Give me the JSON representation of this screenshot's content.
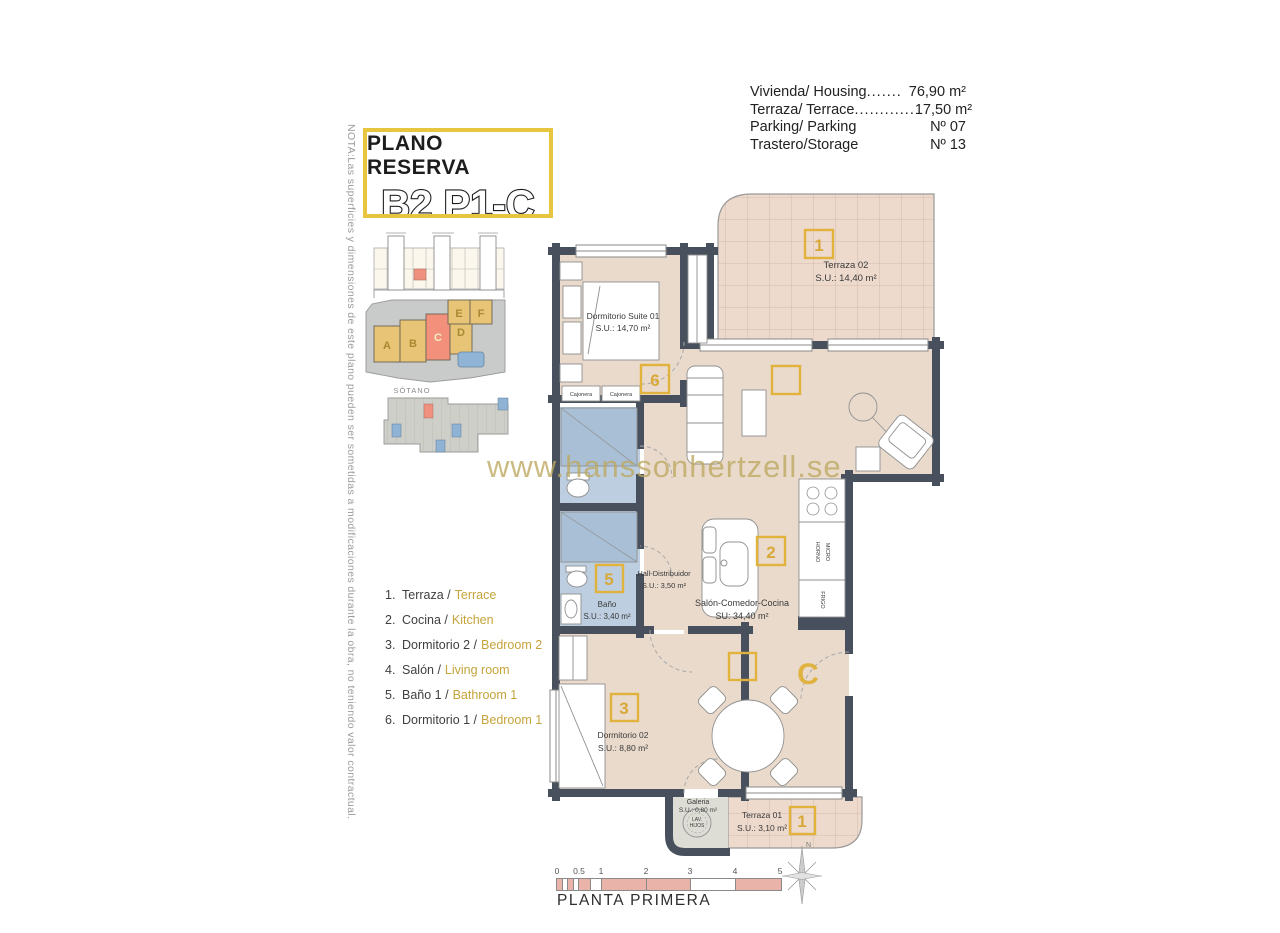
{
  "title_block": {
    "line1": "PLANO RESERVA",
    "line2": "B2 P1-C"
  },
  "note_vertical": "NOTA:Las superficies y dimensiones de este plano pueden ser sometidas a modificaciones durante la obra, no teniendo valor contractual.",
  "info_block": {
    "rows": [
      {
        "label": "Vivienda/ Housing",
        "leader": ".......",
        "value": "76,90 m²"
      },
      {
        "label": "Terraza/ Terrace",
        "leader": "............",
        "value": "17,50 m²"
      },
      {
        "label": "Parking/ Parking",
        "leader": "",
        "value": "Nº 07"
      },
      {
        "label": "Trastero/Storage",
        "leader": "",
        "value": "Nº 13"
      }
    ]
  },
  "site": {
    "sotano_label": "SÓTANO",
    "buildings": [
      "A",
      "B",
      "C",
      "D",
      "E",
      "F"
    ]
  },
  "legend": {
    "items": [
      {
        "num": "1.",
        "es": "Terraza /",
        "en": "Terrace"
      },
      {
        "num": "2.",
        "es": "Cocina /",
        "en": "Kitchen"
      },
      {
        "num": "3.",
        "es": "Dormitorio 2 /",
        "en": "Bedroom 2"
      },
      {
        "num": "4.",
        "es": "Salón /",
        "en": "Living room"
      },
      {
        "num": "5.",
        "es": "Baño 1 /",
        "en": "Bathroom 1"
      },
      {
        "num": "6.",
        "es": "Dormitorio 1 /",
        "en": "Bedroom 1"
      }
    ]
  },
  "watermark": "www.hanssonhertzell.se",
  "plan": {
    "rooms": {
      "terraza02": {
        "name": "Terraza 02",
        "area": "S.U.: 14,40 m²",
        "tag": "1"
      },
      "suite": {
        "name": "Dormitorio Suite 01",
        "area": "S.U.: 14,70 m²",
        "tag": "6"
      },
      "hall": {
        "name": "Hall-Distribuidor",
        "area": "S.U.: 3,50 m²"
      },
      "salon": {
        "name": "Salón-Comedor-Cocina",
        "area": "SU: 34,40 m²",
        "tag": "2"
      },
      "living_tag": "4",
      "dining_tag": "4",
      "bano": {
        "name": "Baño",
        "area": "S.U.: 3,40 m²",
        "tag": "5"
      },
      "dorm02": {
        "name": "Dormitorio 02",
        "area": "S.U.: 8,80 m²",
        "tag": "3"
      },
      "galeria": {
        "name": "Galeria",
        "area": "S.U.: 0,80 m²"
      },
      "terraza01": {
        "name": "Terraza 01",
        "area": "S.U.: 3,10 m²",
        "tag": "1"
      }
    },
    "fixtures": {
      "cajonera": "Cajonera",
      "lav_line1": "LAV.",
      "lav_line2": "HIJOS",
      "horno": "HORNO",
      "micro": "MICRO",
      "frigo": "FRIGO"
    },
    "door_letter": "C",
    "compass_north": "N"
  },
  "footer": {
    "scale_ticks": [
      "0",
      "0.5",
      "1",
      "2",
      "3",
      "4",
      "5"
    ],
    "caption": "PLANTA PRIMERA"
  },
  "colors": {
    "accent_gold": "#E2B33C",
    "title_border": "#E8C53F",
    "wall": "#47505C",
    "floor": "#E9DACC",
    "terrace_grid": "#CDB2A3",
    "bath_blue": "#BCCEDF",
    "highlight_red": "#F0907E",
    "pool_blue": "#8FB4D6",
    "scale_pink": "#E9B3AA",
    "legend_gold": "#C5A43B",
    "watermark_gold": "#BDA85F"
  }
}
